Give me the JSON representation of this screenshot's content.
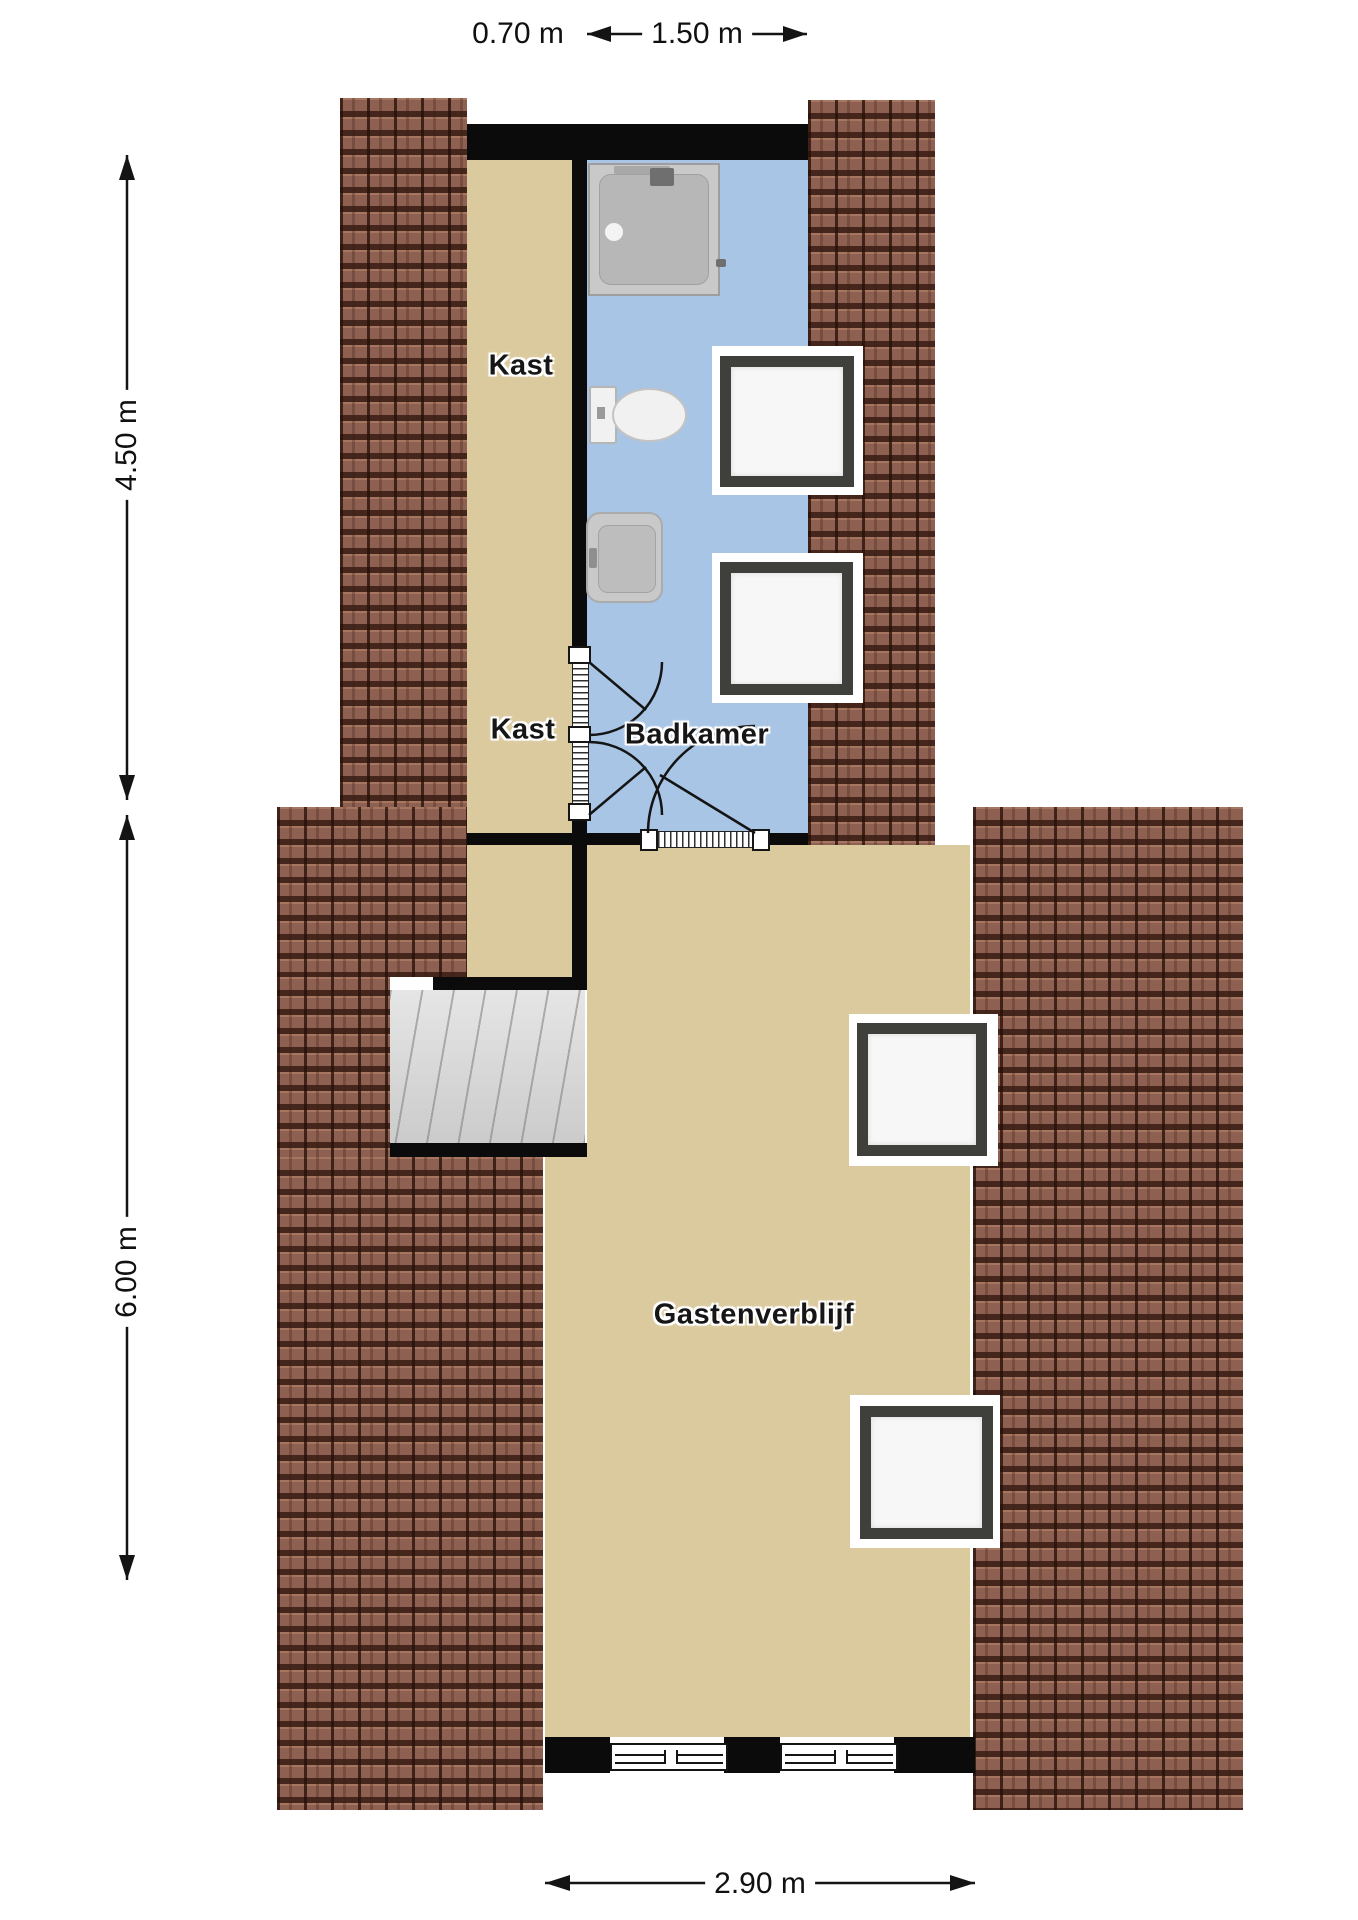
{
  "plan": {
    "type": "floorplan-top-view",
    "labels": {
      "kast_top": "Kast",
      "kast_mid": "Kast",
      "badkamer": "Badkamer",
      "gastenverblijf": "Gastenverblijf"
    },
    "dimensions": {
      "top_left": "0.70 m",
      "top_main": "1.50 m",
      "left_upper": "4.50 m",
      "left_lower": "6.00 m",
      "bottom": "2.90 m"
    },
    "colors": {
      "roof_tiles": "#8e6051",
      "floor_tan": "#dcca9f",
      "bathroom_blue": "#a9c5e5",
      "wall": "#0b0b0b",
      "stairs": "#d8d8d8",
      "window_frame": "#3f3f3c"
    },
    "fixtures": {
      "shower": "shower",
      "toilet": "toilet",
      "sink": "sink",
      "staircase": "staircase",
      "skylights": "4",
      "doors": "2"
    }
  }
}
